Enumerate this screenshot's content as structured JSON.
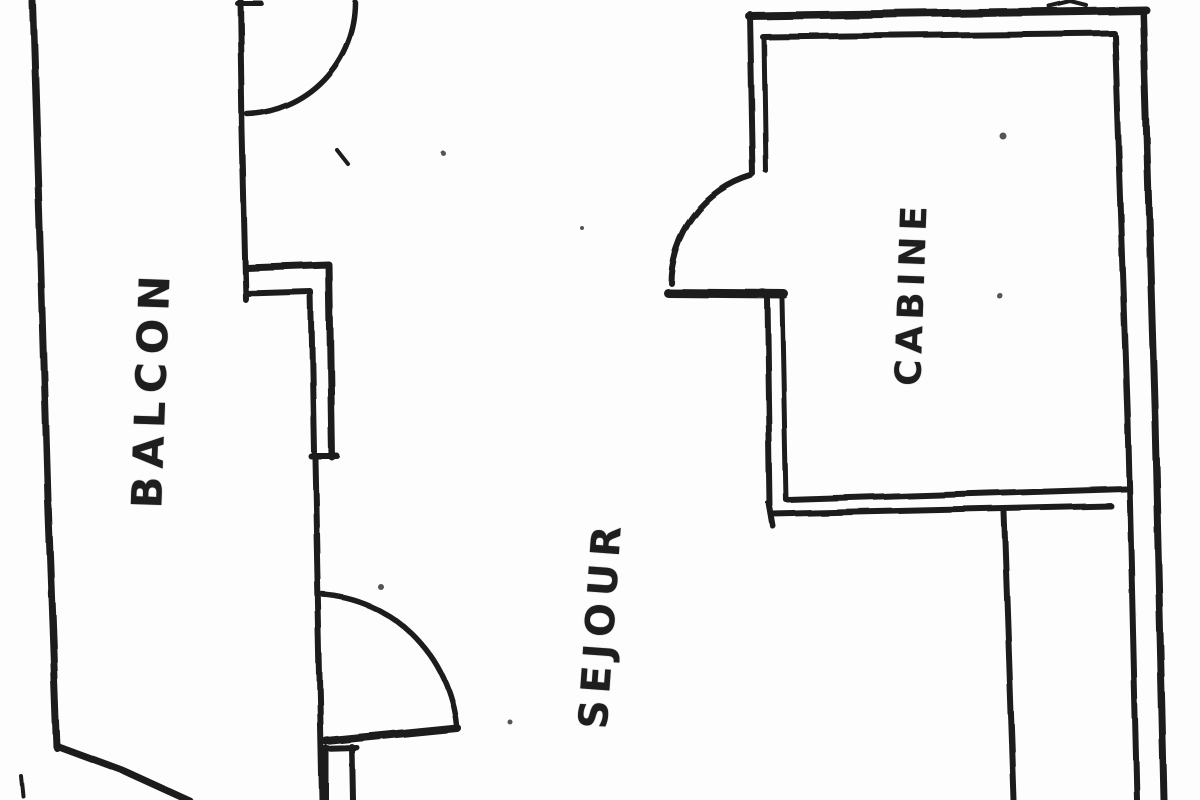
{
  "page": {
    "background": "#fdfdfd",
    "ink": "#1e1e1e"
  },
  "floor_plan": {
    "type": "hand-drawn-scan",
    "rooms": [
      {
        "id": "balcon",
        "label": "BALCON"
      },
      {
        "id": "sejour",
        "label": "SEJOUR"
      },
      {
        "id": "cabine",
        "label": "CABINE"
      }
    ]
  }
}
